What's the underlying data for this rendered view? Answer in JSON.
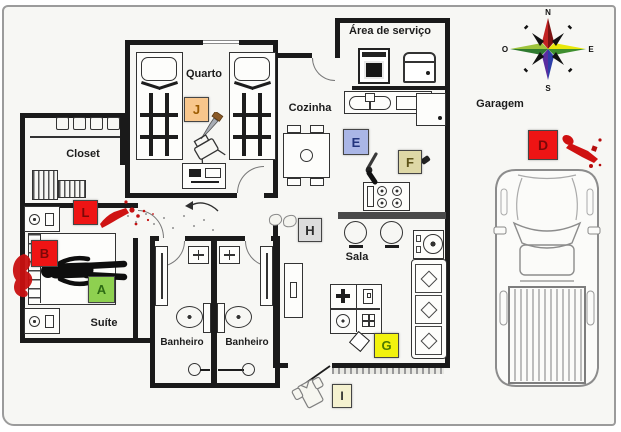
{
  "rooms": {
    "quarto": "Quarto",
    "closet": "Closet",
    "suite": "Suíte",
    "banheiro_left": "Banheiro",
    "banheiro_right": "Banheiro",
    "cozinha": "Cozinha",
    "area_servico": "Área de serviço",
    "sala": "Sala",
    "garagem": "Garagem"
  },
  "markers": {
    "A": {
      "label": "A",
      "bg": "#8ed050",
      "fg": "#2d6b14",
      "location": "suite bed"
    },
    "B": {
      "label": "B",
      "bg": "#ee1414",
      "fg": "#7c0808",
      "location": "suite headboard"
    },
    "D": {
      "label": "D",
      "bg": "#ee1414",
      "fg": "#7c0808",
      "location": "garagem"
    },
    "E": {
      "label": "E",
      "bg": "#aab6e6",
      "fg": "#23357d",
      "location": "cozinha"
    },
    "F": {
      "label": "F",
      "bg": "#ded8a6",
      "fg": "#5d5318",
      "location": "cozinha"
    },
    "G": {
      "label": "G",
      "bg": "#f2f20e",
      "fg": "#4c7a00",
      "location": "sala"
    },
    "H": {
      "label": "H",
      "bg": "#dcdcdc",
      "fg": "#2b2b2b",
      "location": "hall next to sala"
    },
    "I": {
      "label": "I",
      "bg": "#f4f1cf",
      "fg": "#2b2b2b",
      "location": "outside front door"
    },
    "J": {
      "label": "J",
      "bg": "#f8c68c",
      "fg": "#9c5a00",
      "location": "quarto"
    },
    "L": {
      "label": "L",
      "bg": "#ee1414",
      "fg": "#7c0808",
      "location": "suite wall"
    }
  },
  "compass": {
    "north": "N",
    "east": "E",
    "south": "S",
    "west": "O"
  },
  "icons": {
    "compass-rose": "8-point wind rose, N/E/S/O",
    "body-outline": "black body silhouette on suite bed",
    "blood-pool": "red stain beside suite bed",
    "blood-spatter": "red smear and drops near suite door",
    "bloody-knife": "red knife stain in garage",
    "knife": "knife on quarto floor near marker J",
    "revolver": "handgun on cozinha floor near marker E",
    "bullet-casing": "casing near marker F",
    "gloves": "pair of gloves near marker H",
    "card-object": "diamond-shaped object near marker G",
    "shirt": "garment outside front door near marker I",
    "pickup-truck": "truck parked in garagem",
    "footprint-trail": "gray dot trail in hallway"
  },
  "palette": {
    "wall": "#1a1a1a",
    "blood": "#c81111",
    "furniture_line": "#333333"
  }
}
